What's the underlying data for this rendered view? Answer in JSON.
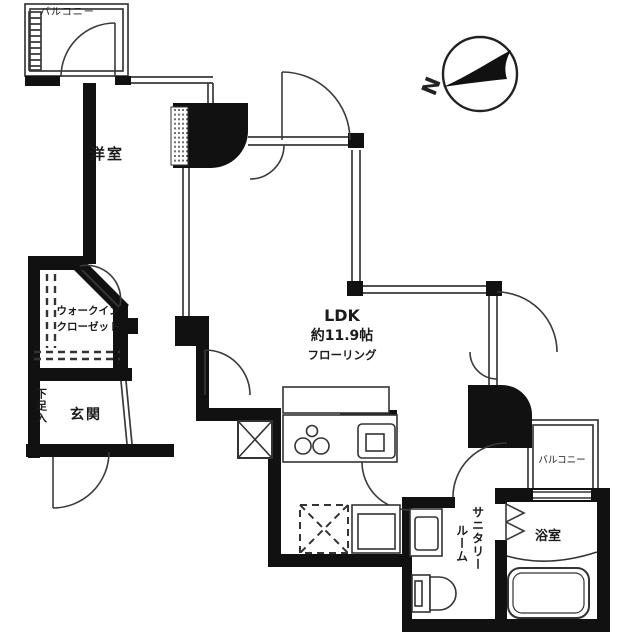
{
  "plan": {
    "type": "apartment-floor-plan",
    "rooms": {
      "balcony_top_left": "バルコニー",
      "western_room": "洋室",
      "walk_in_closet_line1": "ウォークイン",
      "walk_in_closet_line2": "クローゼット",
      "shoe_cabinet": "下足入",
      "entrance": "玄関",
      "ldk_name": "LDK",
      "ldk_size": "約11.9帖",
      "ldk_floor": "フローリング",
      "sanitary_line1": "サニタリー",
      "sanitary_line2": "ルーム",
      "bathroom": "浴室",
      "balcony_right": "バルコニー"
    },
    "compass": {
      "north_label": "N"
    },
    "colors": {
      "wall": "#111111",
      "line": "#333333",
      "background": "#ffffff"
    }
  }
}
